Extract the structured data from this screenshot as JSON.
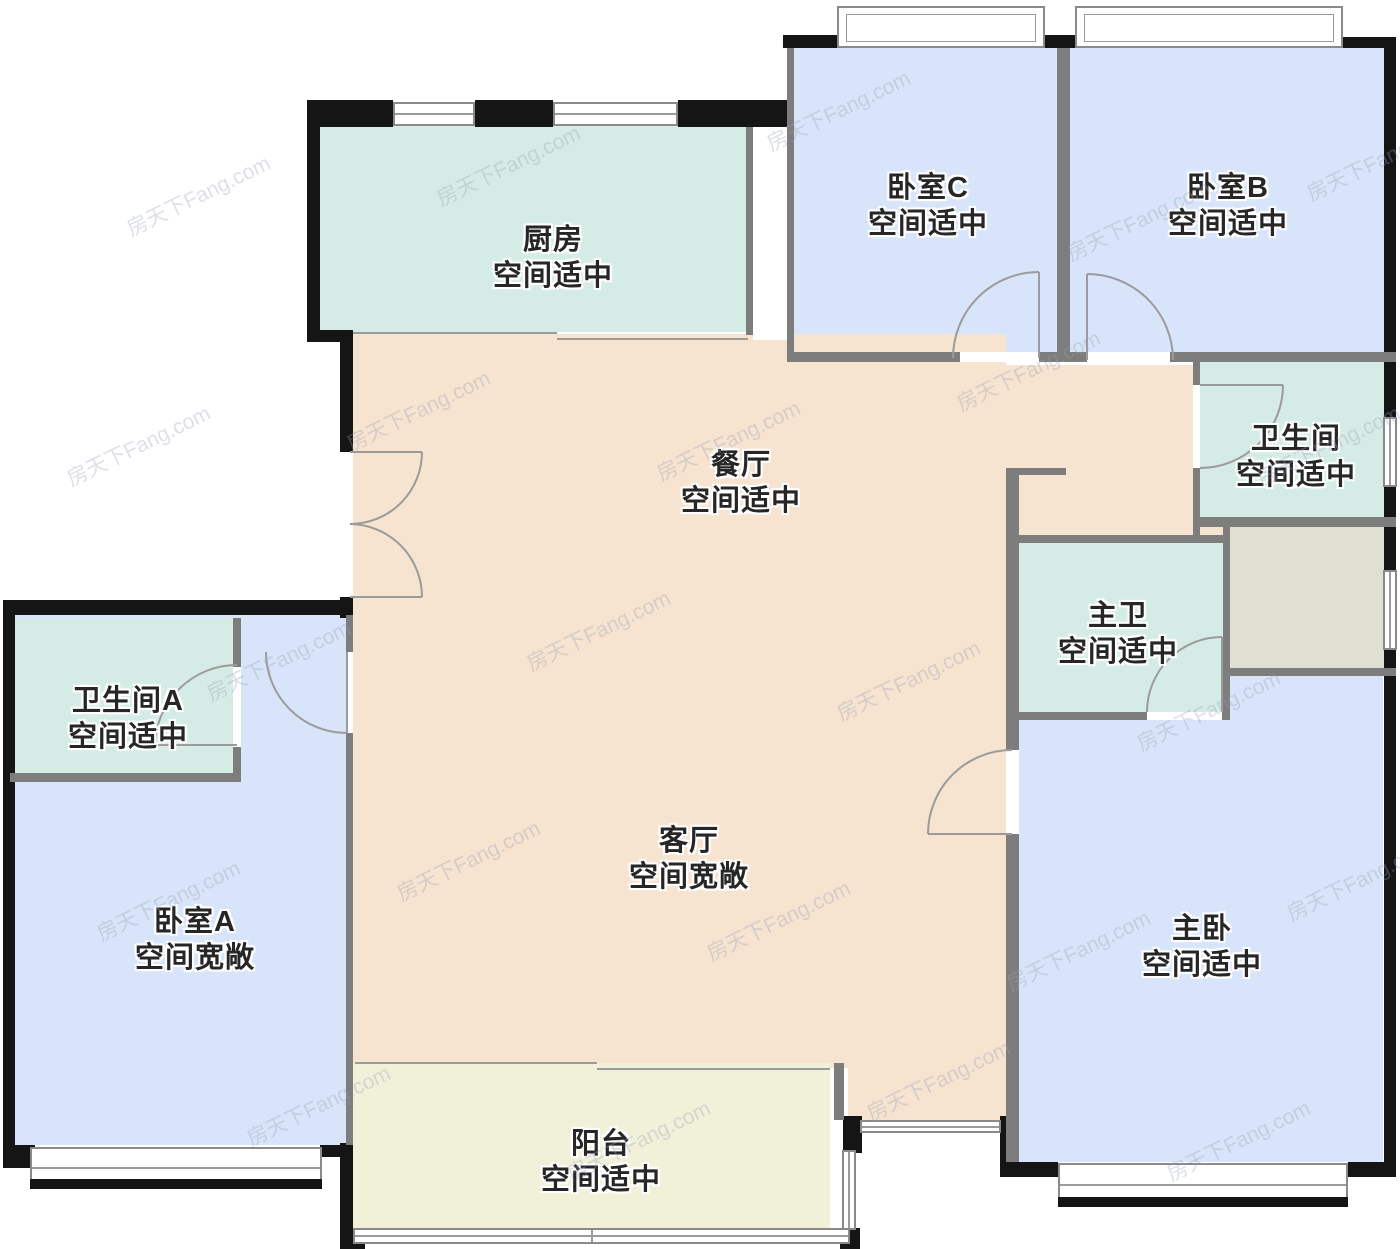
{
  "watermark": "房天下Fang.com",
  "rooms": {
    "kitchen": {
      "name": "厨房",
      "desc": "空间适中"
    },
    "bedroom_c": {
      "name": "卧室C",
      "desc": "空间适中"
    },
    "bedroom_b": {
      "name": "卧室B",
      "desc": "空间适中"
    },
    "dining": {
      "name": "餐厅",
      "desc": "空间适中"
    },
    "bathroom": {
      "name": "卫生间",
      "desc": "空间适中"
    },
    "master_bath": {
      "name": "主卫",
      "desc": "空间适中"
    },
    "bathroom_a": {
      "name": "卫生间A",
      "desc": "空间适中"
    },
    "bedroom_a": {
      "name": "卧室A",
      "desc": "空间宽敞"
    },
    "living": {
      "name": "客厅",
      "desc": "空间宽敞"
    },
    "master_bedroom": {
      "name": "主卧",
      "desc": "空间适中"
    },
    "balcony": {
      "name": "阳台",
      "desc": "空间适中"
    }
  },
  "colors": {
    "bedroom": "#d8e4f9",
    "wet": "#d5ece6",
    "hall": "#f6e3d0",
    "balcony": "#f1f1da",
    "utility": "#dfe0d2",
    "wall": "#151515",
    "partition": "#7d7d7d"
  }
}
